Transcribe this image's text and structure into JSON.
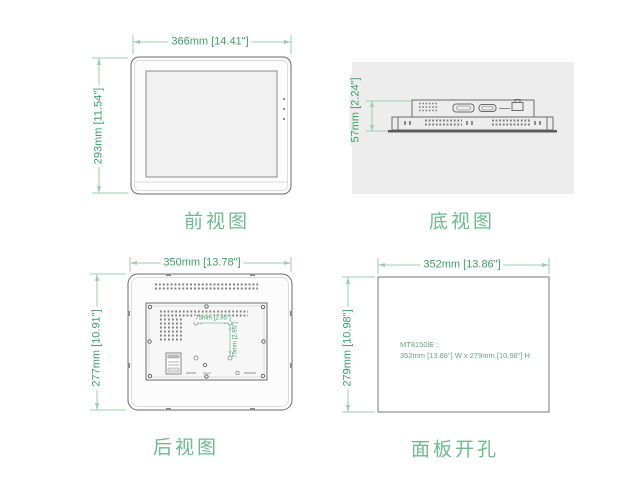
{
  "colors": {
    "dim_text": "#3ca06a",
    "dim_line": "#9bcdb1",
    "label": "#6cbb92",
    "line": "#6b6b6b",
    "backdrop": "#ededed"
  },
  "views": {
    "front": {
      "label": "前视图",
      "width": "366mm [14.41\"]",
      "height": "293mm [11.54\"]"
    },
    "bottom": {
      "label": "底视图",
      "height": "57mm [2.24\"]"
    },
    "rear": {
      "label": "后视图",
      "width": "350mm [13.78\"]",
      "height": "277mm [10.91\"]",
      "vesa_width": "75mm [2.95\"]",
      "vesa_height": "75mm [2.95\"]"
    },
    "cutout": {
      "label": "面板开孔",
      "width": "352mm [13.86\"]",
      "height": "279mm [10.98\"]",
      "model": "MT8150iE :",
      "size": "352mm [13.86\"] W x 279mm [10.98\"] H"
    }
  }
}
